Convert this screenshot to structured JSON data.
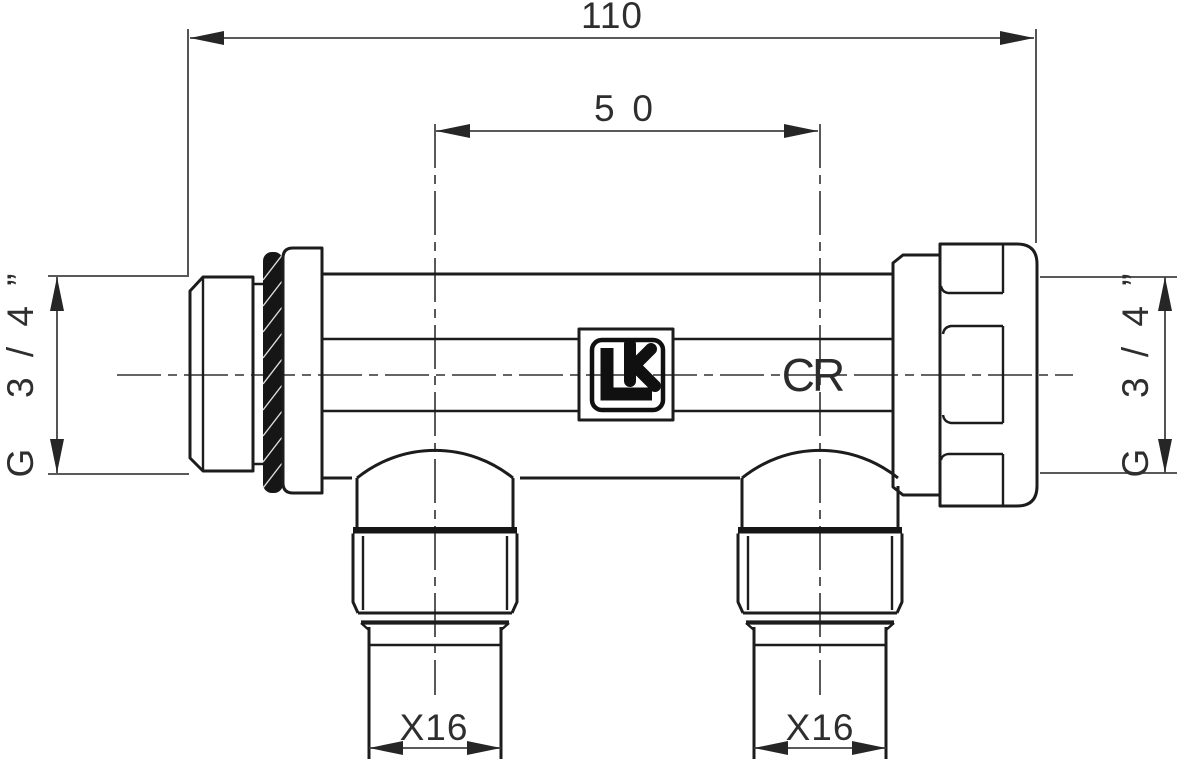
{
  "drawing": {
    "dims": {
      "overall_length": "110",
      "outlet_spacing": "50",
      "left_thread": "G 3/4”",
      "right_thread": "G 3/4”",
      "left_outlet": "X16",
      "right_outlet": "X16"
    },
    "markings": {
      "body_code": "CR",
      "logo": "LK"
    },
    "colors": {
      "line": "#1c1c1c",
      "dimension": "#424242",
      "seal_fill": "#161616",
      "background": "#ffffff"
    }
  }
}
